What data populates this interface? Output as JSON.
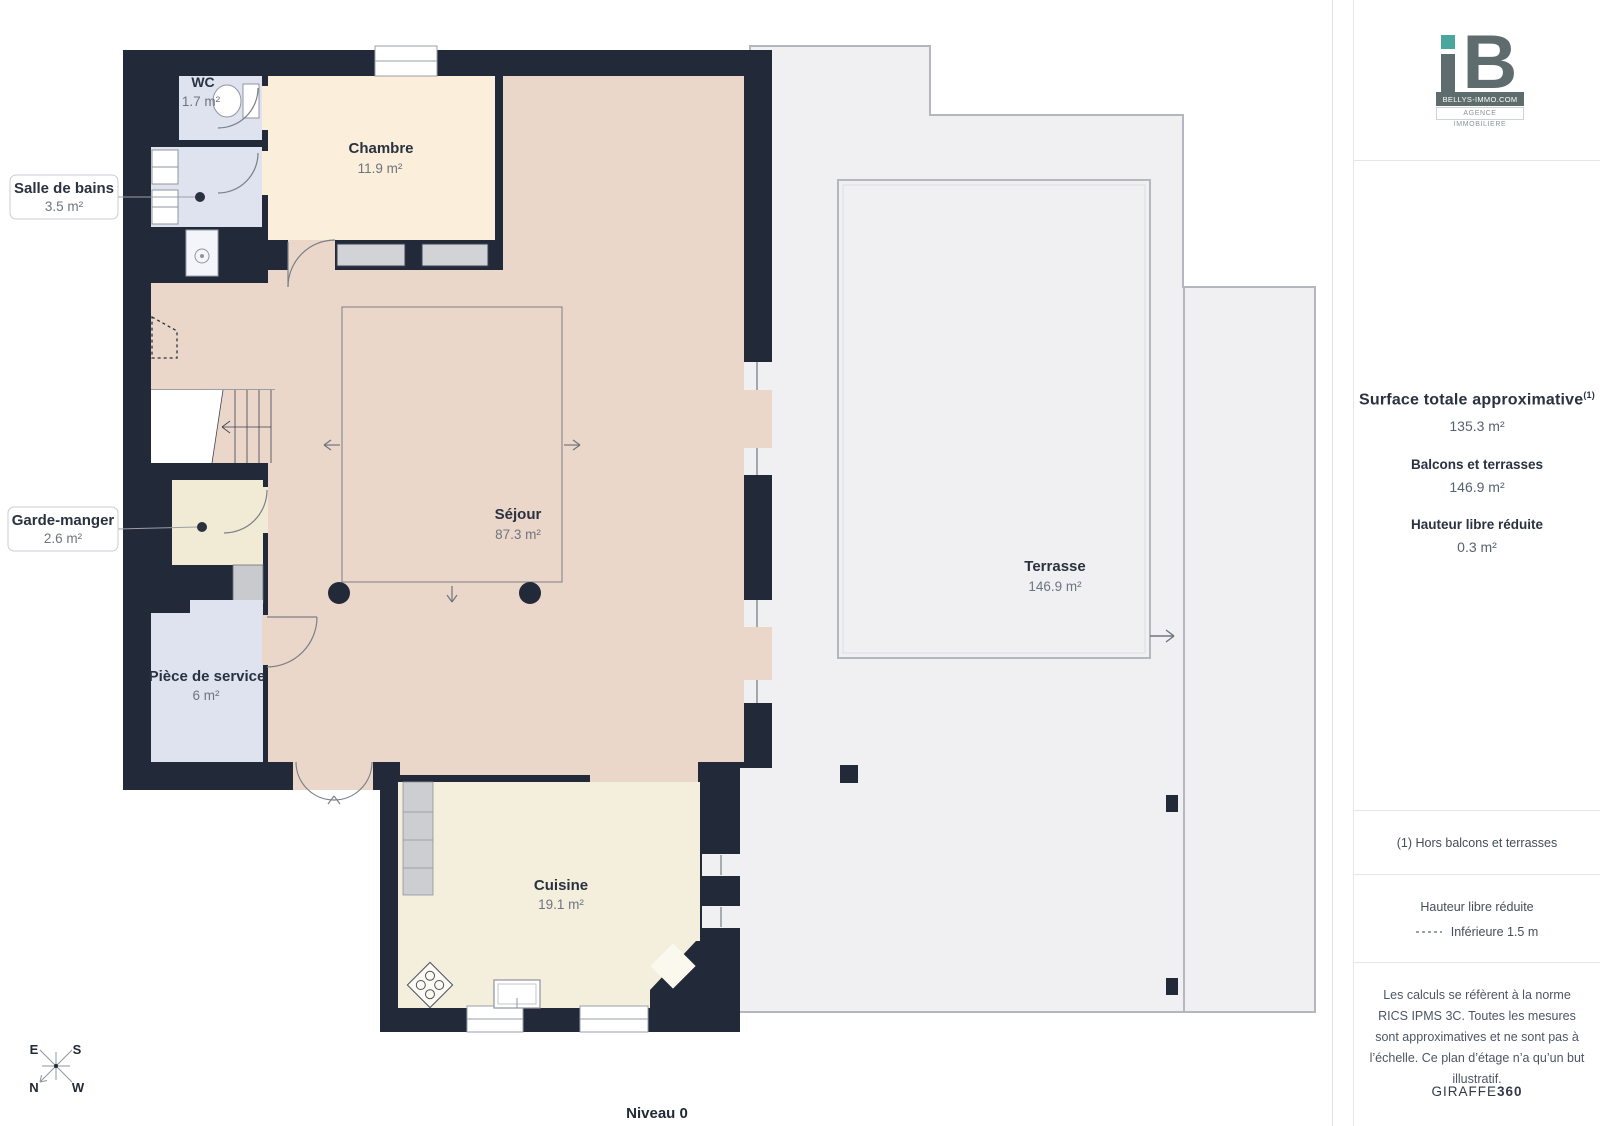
{
  "page": {
    "level_label": "Niveau 0"
  },
  "plan": {
    "rooms": [
      {
        "id": "wc",
        "name": "WC",
        "area": "1.7 m²"
      },
      {
        "id": "salle-de-bains",
        "name": "Salle de bains",
        "area": "3.5 m²"
      },
      {
        "id": "chambre",
        "name": "Chambre",
        "area": "11.9 m²"
      },
      {
        "id": "garde-manger",
        "name": "Garde-manger",
        "area": "2.6 m²"
      },
      {
        "id": "sejour",
        "name": "Séjour",
        "area": "87.3 m²"
      },
      {
        "id": "piece-de-service",
        "name": "Pièce de service",
        "area": "6 m²"
      },
      {
        "id": "cuisine",
        "name": "Cuisine",
        "area": "19.1 m²"
      },
      {
        "id": "terrasse",
        "name": "Terrasse",
        "area": "146.9 m²"
      }
    ],
    "compass": {
      "top_left": "E",
      "top_right": "S",
      "bottom_left": "N",
      "bottom_right": "W"
    }
  },
  "sidebar": {
    "logo": {
      "monogram": "B",
      "line1": "BELLYS-IMMO.COM",
      "line2": "AGENCE IMMOBILIERE"
    },
    "surface": {
      "title": "Surface totale approximative",
      "sup": "(1)",
      "value": "135.3 m²",
      "balconies_label": "Balcons et terrasses",
      "balconies_value": "146.9 m²",
      "reduced_label": "Hauteur libre réduite",
      "reduced_value": "0.3 m²"
    },
    "note": "(1) Hors balcons et terrasses",
    "legend": {
      "title": "Hauteur libre réduite",
      "item": "Inférieure 1.5 m"
    },
    "disclaimer": "Les calculs se réfèrent à la norme RICS IPMS 3C. Toutes les mesures sont approximatives et ne sont pas à l’échelle. Ce plan d’étage n’a qu’un but illustratif.",
    "brand": {
      "regular": "GIRAFFE",
      "bold": "360"
    }
  },
  "colors": {
    "wall": "#222938",
    "sejour": "#ebd7ca",
    "chambre": "#fbeeda",
    "cuisine": "#f4efdc",
    "garde_manger": "#f1ead4",
    "wet_room": "#dfe3ef",
    "terrace": "#f0f0f2",
    "terrace_line": "#b4b7bd",
    "window_fill": "#d2d3d7",
    "accent_teal": "#4ba79b",
    "logo_gray": "#5e6c6d",
    "text_dark": "#2a3240",
    "text_gray": "#6d7480"
  }
}
